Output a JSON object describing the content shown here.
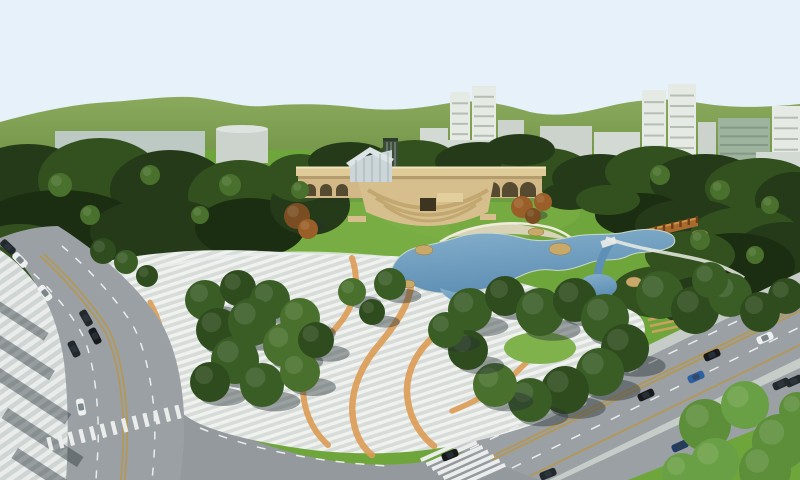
{
  "scene": {
    "label": "Aerial 3D architectural rendering of an urban park master plan with lake, arched bridge, plazas and surrounding roads",
    "legend": {
      "forest_item": "[cx, cy, rx, ry, colorIndex]",
      "tree_item": "[cx, cy, r, colorKey, hasShadow]",
      "car_item": "[cx, cy, rotationDeg, colorKey]",
      "building_item": "[x, y, w, h, colorKey, type, windowBands]"
    }
  },
  "palette": {
    "sky": "#e7f1f9",
    "hills_hi": "#8aa95c",
    "hills_lo": "#6b8e41",
    "forest_dark": "#253a19",
    "forest_mid": "#33511f",
    "forest_deep": "#1c2e12",
    "t1": "#3a5d26",
    "t2": "#2f4c1e",
    "t3": "#49702c",
    "tl": "#5d8f3a",
    "tll": "#6aa045",
    "a1": "#7a4e22",
    "a2": "#9a5f28",
    "lawn": "#6fa63c",
    "lawn_light": "#7fb24a",
    "water_hi": "#86b0cc",
    "water_lo": "#5e8fb4",
    "sand": "#d9d3b6",
    "beach_rim": "#efecdc",
    "rock": "#c9a96a",
    "bridge_tan": "#d2b886",
    "bridge_deck": "#dfcb97",
    "bridge_rail": "#f0e4bb",
    "bridge_shadow": "#a08a5c",
    "arch_dark": "#564b31",
    "terrace_1": "#d6bf8d",
    "terrace_2": "#c2a870",
    "entrance_dark": "#3e3520",
    "pavilion_glass": "#ccd6d9",
    "pavilion_roof": "#dde4e6",
    "glass_tower": "#3e4c3c",
    "pergola": "#a96a2e",
    "pergola_hi": "#cf8f45",
    "pergola_post": "#6e3f17",
    "road": "#9aa0a4",
    "road_b": "#94999d",
    "sidewalk_a": "#cfd5d3",
    "sidewalk_b": "#e9eceb",
    "plaza_a": "#d7dcd9",
    "plaza_b": "#f0f2f0",
    "plaza_orange": "#dc9c55",
    "curb": "#c6ccc8",
    "mark_white": "#eaedec",
    "mark_yellow": "#b6974f",
    "shadow": "rgba(38,48,52,0.42)",
    "car_white": "#eef0ef",
    "car_black": "#17191c",
    "car_dark": "#23282c",
    "car_blue": "#2e5fa3",
    "car_navy": "#223c63",
    "building_a": "#bdc9c3",
    "building_b": "#d3dad3",
    "building_c": "#e6eae4",
    "building_d": "#ccd3cc",
    "glass_band": "#9db39d",
    "cabin": "#313d46",
    "steps_tan": "#caa15c"
  },
  "buildings": [
    [
      55,
      131,
      150,
      32,
      "building_a",
      "box",
      0
    ],
    [
      216,
      129,
      52,
      34,
      "building_d",
      "cyl",
      0
    ],
    [
      420,
      128,
      28,
      36,
      "building_b",
      "box",
      0
    ],
    [
      450,
      92,
      20,
      72,
      "building_c",
      "box",
      6
    ],
    [
      472,
      86,
      24,
      78,
      "building_c",
      "box",
      7
    ],
    [
      498,
      120,
      26,
      44,
      "building_d",
      "box",
      0
    ],
    [
      436,
      140,
      72,
      24,
      "building_b",
      "box",
      0
    ],
    [
      540,
      126,
      52,
      36,
      "building_d",
      "box",
      0
    ],
    [
      594,
      132,
      46,
      30,
      "building_b",
      "box",
      0
    ],
    [
      642,
      90,
      24,
      78,
      "building_c",
      "box",
      6
    ],
    [
      668,
      84,
      28,
      84,
      "building_c",
      "box",
      7
    ],
    [
      698,
      122,
      18,
      46,
      "building_d",
      "box",
      0
    ],
    [
      718,
      118,
      52,
      52,
      "glass_band",
      "box",
      5
    ],
    [
      772,
      106,
      28,
      64,
      "building_c",
      "box",
      5
    ],
    [
      756,
      152,
      44,
      18,
      "building_b",
      "box",
      0
    ]
  ],
  "forest": [
    [
      28,
      192,
      70,
      48,
      0
    ],
    [
      100,
      180,
      62,
      42,
      1
    ],
    [
      170,
      190,
      60,
      40,
      0
    ],
    [
      240,
      196,
      52,
      36,
      1
    ],
    [
      60,
      230,
      85,
      40,
      2
    ],
    [
      160,
      232,
      70,
      34,
      0
    ],
    [
      250,
      228,
      55,
      30,
      2
    ],
    [
      20,
      258,
      55,
      34,
      1
    ],
    [
      310,
      205,
      40,
      30,
      0
    ],
    [
      300,
      178,
      35,
      24,
      1
    ],
    [
      350,
      162,
      42,
      20,
      0
    ],
    [
      415,
      158,
      40,
      18,
      1
    ],
    [
      480,
      162,
      45,
      20,
      0
    ],
    [
      545,
      170,
      45,
      22,
      1
    ],
    [
      520,
      150,
      35,
      16,
      0
    ],
    [
      600,
      178,
      48,
      24,
      0
    ],
    [
      655,
      172,
      50,
      26,
      1
    ],
    [
      705,
      182,
      55,
      28,
      0
    ],
    [
      760,
      188,
      55,
      30,
      1
    ],
    [
      795,
      200,
      40,
      28,
      0
    ],
    [
      640,
      215,
      45,
      22,
      2
    ],
    [
      690,
      225,
      55,
      26,
      0
    ],
    [
      745,
      235,
      55,
      28,
      1
    ],
    [
      785,
      252,
      50,
      30,
      0
    ],
    [
      735,
      265,
      60,
      32,
      2
    ],
    [
      690,
      255,
      45,
      24,
      1
    ],
    [
      660,
      292,
      48,
      26,
      1
    ],
    [
      705,
      302,
      48,
      26,
      0
    ],
    [
      752,
      300,
      45,
      24,
      2
    ],
    [
      790,
      315,
      35,
      22,
      1
    ],
    [
      570,
      196,
      28,
      14,
      0
    ],
    [
      608,
      200,
      32,
      15,
      1
    ]
  ],
  "trees": [
    [
      103,
      251,
      13,
      "t2",
      0
    ],
    [
      126,
      262,
      12,
      "t1",
      0
    ],
    [
      147,
      276,
      11,
      "t2",
      0
    ],
    [
      205,
      300,
      20,
      "t1",
      1
    ],
    [
      238,
      288,
      18,
      "t2",
      1
    ],
    [
      270,
      300,
      20,
      "t1",
      1
    ],
    [
      300,
      318,
      20,
      "t3",
      1
    ],
    [
      218,
      330,
      22,
      "t2",
      1
    ],
    [
      252,
      322,
      24,
      "t1",
      1
    ],
    [
      285,
      345,
      22,
      "t3",
      1
    ],
    [
      235,
      360,
      24,
      "t1",
      1
    ],
    [
      210,
      382,
      20,
      "t2",
      1
    ],
    [
      262,
      385,
      22,
      "t1",
      1
    ],
    [
      300,
      372,
      20,
      "t3",
      1
    ],
    [
      316,
      340,
      18,
      "t2",
      1
    ],
    [
      352,
      292,
      14,
      "t3",
      1
    ],
    [
      390,
      284,
      16,
      "t1",
      1
    ],
    [
      372,
      312,
      13,
      "t2",
      1
    ],
    [
      470,
      310,
      22,
      "t1",
      1
    ],
    [
      505,
      296,
      20,
      "t2",
      1
    ],
    [
      540,
      312,
      24,
      "t1",
      1
    ],
    [
      575,
      300,
      22,
      "t2",
      1
    ],
    [
      605,
      318,
      24,
      "t1",
      1
    ],
    [
      625,
      348,
      24,
      "t2",
      1
    ],
    [
      600,
      372,
      24,
      "t1",
      1
    ],
    [
      565,
      390,
      24,
      "t2",
      1
    ],
    [
      530,
      400,
      22,
      "t1",
      1
    ],
    [
      495,
      385,
      22,
      "t3",
      1
    ],
    [
      468,
      350,
      20,
      "t2",
      1
    ],
    [
      446,
      330,
      18,
      "t1",
      1
    ],
    [
      660,
      295,
      24,
      "t1",
      0
    ],
    [
      695,
      310,
      24,
      "t2",
      0
    ],
    [
      730,
      295,
      22,
      "t1",
      0
    ],
    [
      760,
      312,
      20,
      "t2",
      0
    ],
    [
      710,
      280,
      18,
      "t1",
      0
    ],
    [
      786,
      296,
      18,
      "t2",
      0
    ],
    [
      705,
      425,
      26,
      "tl",
      0
    ],
    [
      745,
      405,
      24,
      "tll",
      0
    ],
    [
      780,
      442,
      28,
      "tl",
      0
    ],
    [
      715,
      462,
      24,
      "tll",
      0
    ],
    [
      765,
      470,
      26,
      "tl",
      0
    ],
    [
      682,
      473,
      20,
      "tll",
      0
    ],
    [
      797,
      410,
      18,
      "tl",
      0
    ],
    [
      60,
      185,
      12,
      "t3",
      0
    ],
    [
      150,
      175,
      10,
      "t3",
      0
    ],
    [
      230,
      185,
      11,
      "t3",
      0
    ],
    [
      90,
      215,
      10,
      "t3",
      0
    ],
    [
      200,
      215,
      9,
      "t3",
      0
    ],
    [
      300,
      190,
      9,
      "t3",
      0
    ],
    [
      660,
      175,
      10,
      "t3",
      0
    ],
    [
      720,
      190,
      10,
      "t3",
      0
    ],
    [
      770,
      205,
      9,
      "t3",
      0
    ],
    [
      700,
      240,
      10,
      "t3",
      0
    ],
    [
      755,
      255,
      9,
      "t3",
      0
    ],
    [
      297,
      216,
      13,
      "a1",
      1
    ],
    [
      308,
      229,
      10,
      "a2",
      0
    ],
    [
      522,
      207,
      11,
      "a2",
      1
    ],
    [
      543,
      202,
      9,
      "a2",
      0
    ],
    [
      533,
      216,
      8,
      "a1",
      0
    ]
  ],
  "cars": [
    [
      8,
      247,
      44,
      "car_dark"
    ],
    [
      20,
      260,
      46,
      "car_white"
    ],
    [
      45,
      293,
      52,
      "car_white"
    ],
    [
      86,
      318,
      60,
      "car_dark"
    ],
    [
      95,
      336,
      63,
      "car_black"
    ],
    [
      74,
      349,
      64,
      "car_dark"
    ],
    [
      81,
      407,
      79,
      "car_white"
    ],
    [
      578,
      404,
      -25,
      "car_white"
    ],
    [
      646,
      395,
      -25,
      "car_black"
    ],
    [
      696,
      377,
      -24,
      "car_blue"
    ],
    [
      712,
      355,
      -24,
      "car_black"
    ],
    [
      765,
      338,
      -24,
      "car_white"
    ],
    [
      781,
      384,
      -24,
      "car_dark"
    ],
    [
      450,
      455,
      -22,
      "car_black"
    ],
    [
      548,
      474,
      -22,
      "car_dark"
    ],
    [
      680,
      446,
      -24,
      "car_navy"
    ],
    [
      699,
      473,
      -24,
      "car_black"
    ],
    [
      794,
      381,
      -24,
      "car_dark"
    ]
  ],
  "crosswalks": [
    {
      "x1": 50,
      "y1": 444,
      "x2": 178,
      "y2": 412,
      "n": 13,
      "len": 14,
      "w": 4.2,
      "rot": 76
    },
    {
      "x1": 446,
      "y1": 449,
      "x2": 480,
      "y2": 476,
      "n": 7,
      "len": 55,
      "w": 4,
      "rot": -24
    }
  ],
  "bridge": {
    "arches_small": [
      310,
      326,
      342
    ],
    "arches_large": [
      402,
      420,
      438,
      456,
      474,
      492,
      510,
      528
    ]
  },
  "pergola": {
    "x1": 598,
    "y1": 246,
    "x2": 697,
    "y2": 222,
    "posts": 13
  },
  "sidewalk_shadows": [
    [
      -10,
      295,
      70,
      9
    ],
    [
      -8,
      330,
      75,
      11
    ],
    [
      0,
      368,
      85,
      12
    ],
    [
      8,
      408,
      90,
      12
    ],
    [
      18,
      448,
      85,
      12
    ]
  ],
  "rocks": [
    [
      424,
      250,
      9,
      5
    ],
    [
      560,
      249,
      11,
      6
    ],
    [
      536,
      232,
      8,
      4
    ],
    [
      634,
      282,
      8,
      5
    ],
    [
      408,
      284,
      7,
      4
    ],
    [
      700,
      234,
      8,
      4
    ]
  ]
}
